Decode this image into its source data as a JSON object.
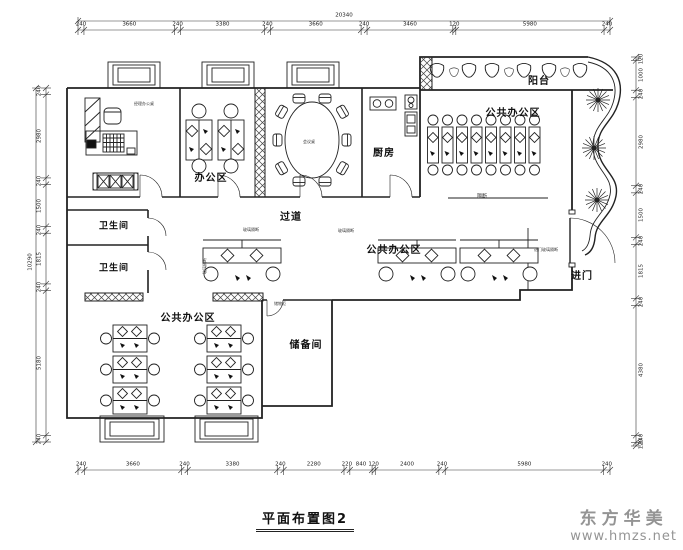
{
  "title": "平面布置图2",
  "watermark": {
    "brand": "东方华美",
    "site": "www.hmzs.net"
  },
  "labels": {
    "balcony": "阳台",
    "kitchen": "厨房",
    "office_area": "办公区",
    "public_office_top": "公共办公区",
    "public_office_mid": "公共办公区",
    "public_office_bottom": "公共办公区",
    "corridor": "过道",
    "restroom_upper": "卫生间",
    "restroom_lower": "卫生间",
    "storage": "储备间",
    "entrance": "进门",
    "partition": "隔断",
    "notes": {
      "manager_desk": "经理办公桌",
      "meeting_table": "会议桌",
      "partition_1": "玻璃隔断",
      "partition_2": "玻璃隔断",
      "partition_3": "玻璃隔断",
      "entry_partition": "进门玻璃隔断",
      "storage_cabinet": "储物柜"
    }
  },
  "dimensions": {
    "top_total": "20340",
    "left_total": "10290",
    "top": [
      "240",
      "3660",
      "240",
      "3380",
      "240",
      "3660",
      "240",
      "3460",
      "120",
      "5980",
      "240"
    ],
    "bottom": [
      "240",
      "3660",
      "240",
      "3380",
      "240",
      "2280",
      "220",
      "840",
      "120",
      "2400",
      "240",
      "5980",
      "240"
    ],
    "left": [
      "240",
      "2980",
      "240",
      "1500",
      "240",
      "1815",
      "240",
      "5180",
      "240"
    ],
    "right": [
      "120",
      "1000",
      "240",
      "2980",
      "240",
      "1500",
      "240",
      "1815",
      "240",
      "4380",
      "240",
      "120"
    ]
  }
}
